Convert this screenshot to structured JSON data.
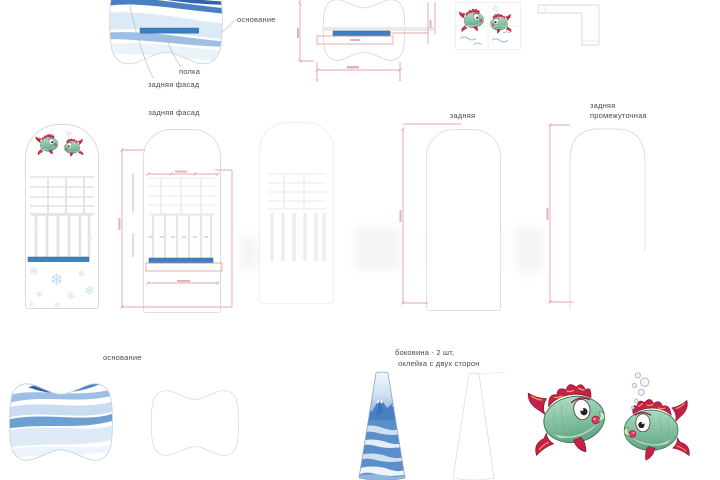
{
  "labels": {
    "top_base": "основание",
    "top_shelf": "полка",
    "top_back_facade": "задняя фасад",
    "back_facade_title": "задняя фасад",
    "back_title": "задняя",
    "back_mid_line1": "задняя",
    "back_mid_line2": "промежуточная",
    "bottom_base": "основание",
    "side_note_line1": "боковина - 2 шт,",
    "side_note_line2": "оклейка с двух сторон"
  },
  "icons": {
    "snowflake_glyph": "❄",
    "fish_pair": "fish-pair-illustration",
    "mountains": "mountain-artwork"
  },
  "palette": {
    "accent_blue": "#3d7fc4",
    "stripe_dark_blue": "#2f66ad",
    "stripe_mid_blue": "#6f9fd0",
    "stripe_light_blue": "#c9dcf0",
    "stripe_pale_blue": "#e4eef8",
    "dimension_red": "#d98d8d",
    "outline_gray": "#dcdcdc",
    "ghost_gray": "#f0f0f0",
    "label_gray": "#4a4a4a",
    "fish_body_green": "#7fbf9e",
    "fish_fin_red": "#c2224a",
    "fish_fin_orange": "#f2a03c",
    "snowflake_blue": "#cfe2f5",
    "mountain_blue": "#4a80c2"
  }
}
